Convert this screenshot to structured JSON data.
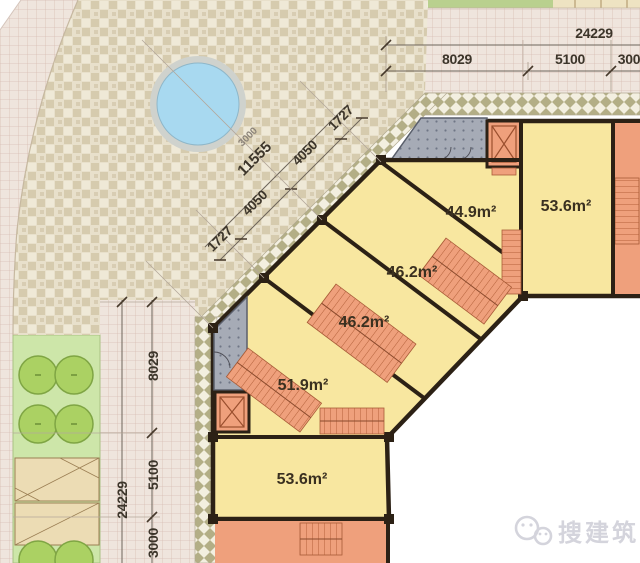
{
  "rooms": {
    "unit1": "44.9m²",
    "unit2": "53.6m²",
    "unit3": "46.2m²",
    "unit4": "46.2m²",
    "unit5": "51.9m²",
    "unit6": "53.6m²"
  },
  "dimensions": {
    "top_total": "24229",
    "top_seg1": "8029",
    "top_seg2": "5100",
    "top_seg3": "300",
    "left_total": "24229",
    "left_seg1": "8029",
    "left_seg2": "5100",
    "left_seg3": "3000",
    "diag_total": "11555",
    "diag_seg1": "1727",
    "diag_seg2": "4050",
    "diag_seg3": "4050",
    "diag_seg4": "1727",
    "pool_diameter": "3000"
  },
  "watermark": {
    "text": "搜建筑"
  },
  "colors": {
    "room_fill": "#f8e7a0",
    "stair_fill": "#efa07c",
    "wall": "#2c2115",
    "pool_water": "#a8d9f0",
    "plaza_tile": "#d6cbae",
    "walkway_olive": "#b3ae86",
    "road_grid": "#d8beb4",
    "green_strip": "#cde6a9",
    "tree": "#abd163",
    "lobby_gray": "#a6abb6"
  }
}
